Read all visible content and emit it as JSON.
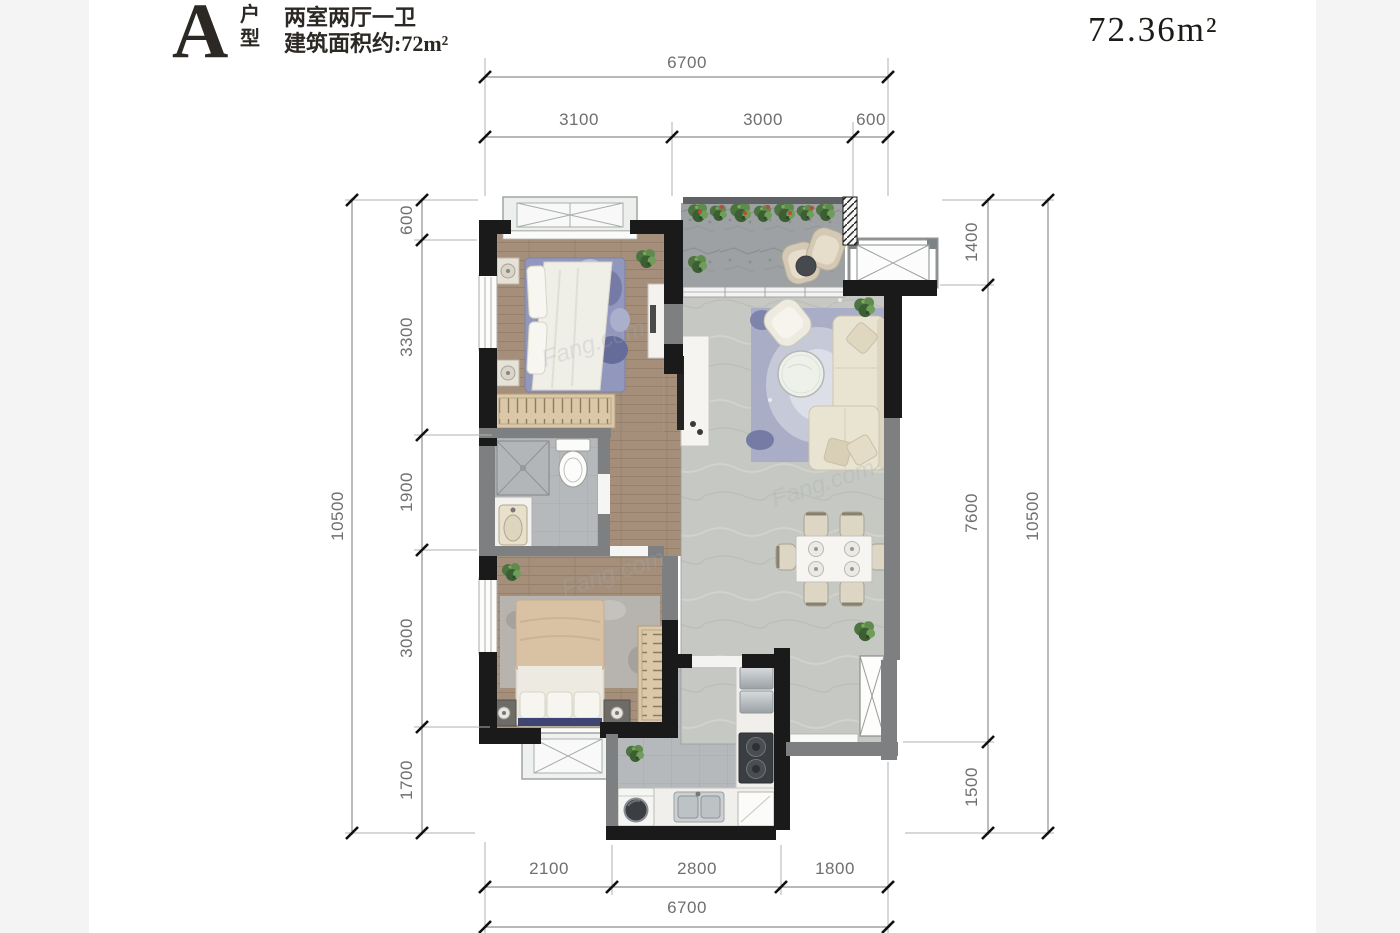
{
  "header": {
    "type_letter": "A",
    "type_label": "户型",
    "line1": "两室两厅一卫",
    "line2": "建筑面积约:72m²",
    "area": "72.36m²"
  },
  "dims": {
    "top_total": "6700",
    "top_segs": [
      "3100",
      "3000",
      "600"
    ],
    "left_total": "10500",
    "left_segs": [
      "600",
      "3300",
      "1900",
      "3000",
      "1700"
    ],
    "right_total": "10500",
    "right_segs": [
      "1400",
      "7600",
      "1500"
    ],
    "bottom_total": "6700",
    "bottom_segs": [
      "2100",
      "2800",
      "1800"
    ]
  },
  "watermark": "Fang.com",
  "colors": {
    "wall_black": "#1a1a1a",
    "wall_gray": "#7d7f81",
    "wood_floor": "#a58f7b",
    "tile_floor": "#b6b9bc",
    "living_tile": "#c5c8c3",
    "balcony_stone": "#9da1a3",
    "accent_rug_blue": "#9298bd",
    "dim_text": "#6f6f6f"
  }
}
